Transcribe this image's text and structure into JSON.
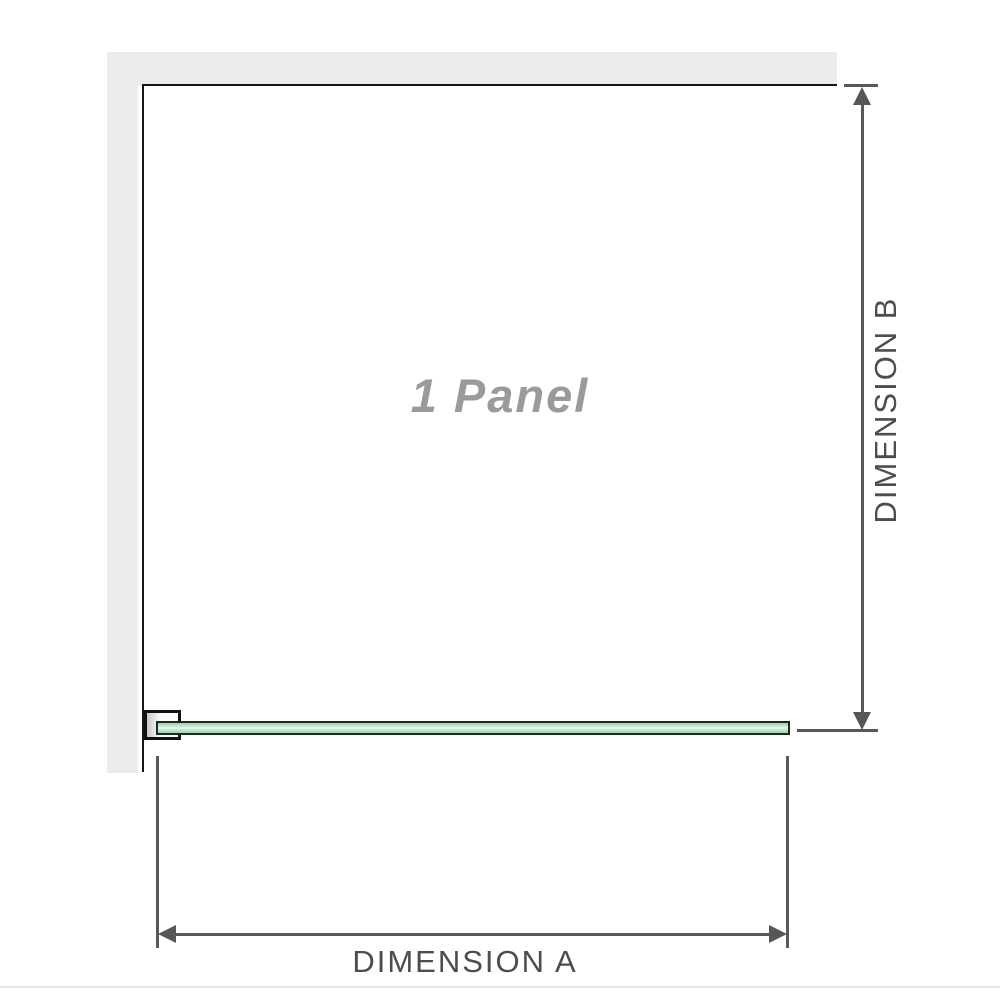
{
  "diagram": {
    "type": "shower-screen-plan-diagram",
    "title": "1 Panel",
    "dimension_a_label": "DIMENSION A",
    "dimension_b_label": "DIMENSION B",
    "colors": {
      "background": "#ffffff",
      "wall_fill": "#ececec",
      "enclosure_outline": "#161616",
      "glass_green": "#9dd2b2",
      "glass_highlight": "#ecf8f0",
      "glass_border": "#1c2a20",
      "bracket_outline": "#111111",
      "dimension_line": "#575757",
      "dimension_text": "#4d4d4d",
      "watermark_text": "#9a9a9a",
      "bottom_edge_line": "#e4e4e0"
    }
  }
}
